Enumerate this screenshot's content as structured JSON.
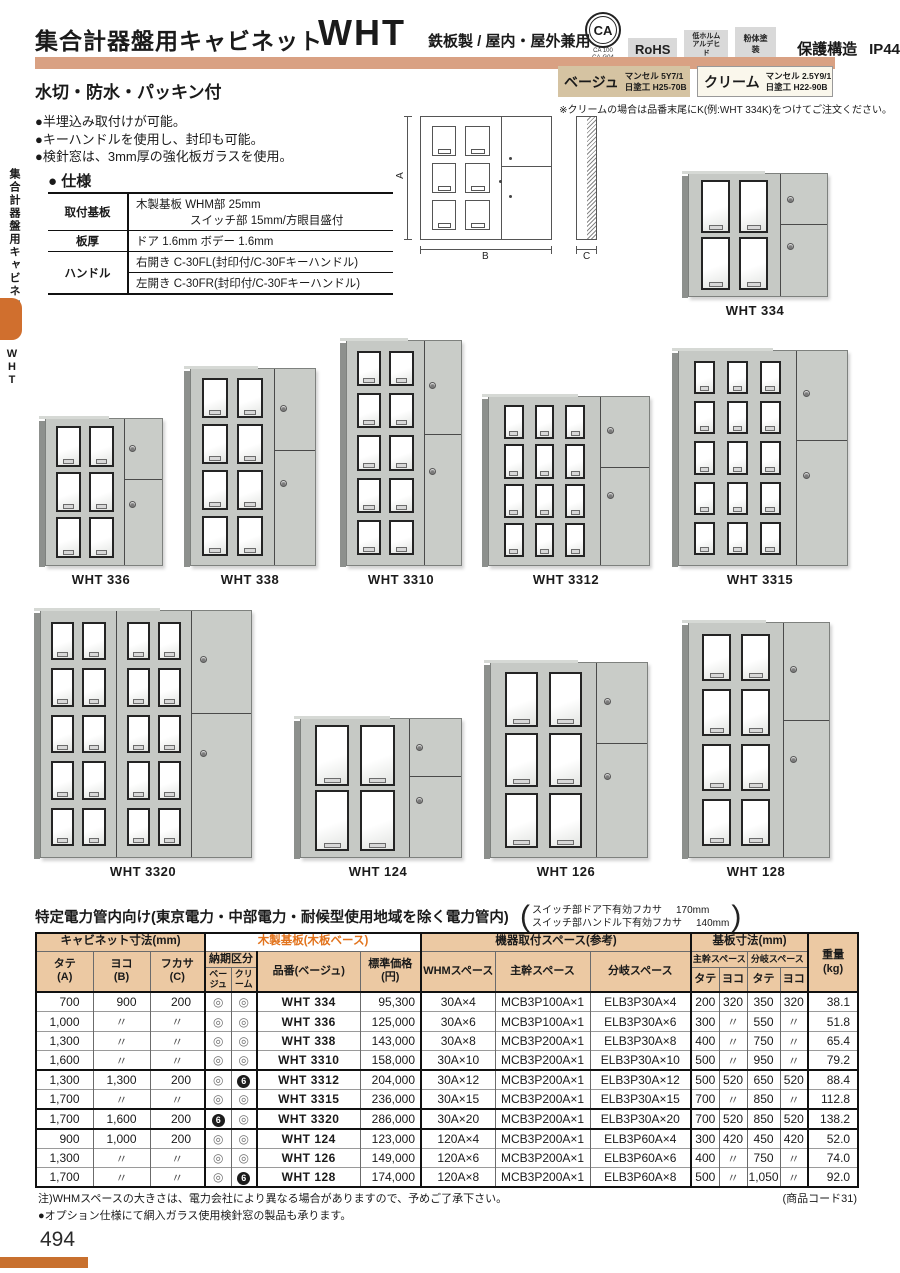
{
  "sidebar": {
    "title": "集合計器盤用キャビネット",
    "tab": "WHT"
  },
  "header": {
    "title": "集合計器盤用キャビネット",
    "model": "WHT",
    "subtitle": "鉄板製 / 屋内・屋外兼用",
    "ca": "CA",
    "ca_sub1": "CA 100",
    "ca_sub2": "CA-G04",
    "rohs": "RoHS",
    "formaldehyde1": "低ホルム",
    "formaldehyde2": "アルデヒド",
    "powder": "粉体塗装",
    "protection": "保護構造",
    "ip": "IP44"
  },
  "feature": "水切・防水・パッキン付",
  "colors": {
    "beige_name": "ベージュ",
    "beige_line1": "マンセル 5Y7/1",
    "beige_line2": "日塗工 H25-70B",
    "beige_hex": "#d5c3a2",
    "cream_name": "クリーム",
    "cream_line1": "マンセル 2.5Y9/1",
    "cream_line2": "日塗工 H22-90B",
    "cream_hex": "#faf7ec",
    "note": "※クリームの場合は品番末尾にK(例:WHT 334K)をつけてご注文ください。"
  },
  "bullets": [
    "●半埋込み取付けが可能。",
    "●キーハンドルを使用し、封印も可能。",
    "●検針窓は、3mm厚の強化板ガラスを使用。"
  ],
  "spec": {
    "heading": "● 仕様",
    "r1_label": "取付基板",
    "r1_line1": "木製基板 WHM部 25mm",
    "r1_line2": "スイッチ部 15mm/方眼目盛付",
    "r2_label": "板厚",
    "r2_value": "ドア 1.6mm ボデー 1.6mm",
    "r3_label": "ハンドル",
    "r3_value": "右開き C-30FL(封印付/C-30Fキーハンドル)",
    "r4_value": "左開き C-30FR(封印付/C-30Fキーハンドル)"
  },
  "diagram": {
    "a": "A",
    "b": "B",
    "c": "C"
  },
  "products": [
    {
      "label": "WHT 334",
      "doors": [
        {
          "cols": 2,
          "rows": 2
        }
      ]
    },
    {
      "label": "WHT 336",
      "doors": [
        {
          "cols": 2,
          "rows": 3
        }
      ]
    },
    {
      "label": "WHT 338",
      "doors": [
        {
          "cols": 2,
          "rows": 4
        }
      ]
    },
    {
      "label": "WHT 3310",
      "doors": [
        {
          "cols": 2,
          "rows": 5
        }
      ]
    },
    {
      "label": "WHT 3312",
      "doors": [
        {
          "cols": 3,
          "rows": 4
        }
      ]
    },
    {
      "label": "WHT 3315",
      "doors": [
        {
          "cols": 3,
          "rows": 5
        }
      ]
    },
    {
      "label": "WHT 3320",
      "doors": [
        {
          "cols": 2,
          "rows": 5
        },
        {
          "cols": 2,
          "rows": 5
        }
      ]
    },
    {
      "label": "WHT 124",
      "doors": [
        {
          "cols": 2,
          "rows": 2
        }
      ]
    },
    {
      "label": "WHT 126",
      "doors": [
        {
          "cols": 2,
          "rows": 3
        }
      ]
    },
    {
      "label": "WHT 128",
      "doors": [
        {
          "cols": 2,
          "rows": 4
        }
      ]
    }
  ],
  "table": {
    "title": "特定電力管内向け(東京電力・中部電力・耐候型使用地域を除く電力管内)",
    "note1_label": "スイッチ部ドア下有効フカサ",
    "note1_value": "170mm",
    "note2_label": "スイッチ部ハンドル下有効フカサ",
    "note2_value": "140mm",
    "h_cabinet": "キャビネット寸法(mm)",
    "h_wood": "木製基板(木板ベース)",
    "h_equip": "機器取付スペース(参考)",
    "h_board": "基板寸法(mm)",
    "h_weight1": "重量",
    "h_weight2": "(kg)",
    "h_tate1": "タテ",
    "h_tate2": "(A)",
    "h_yoko1": "ヨコ",
    "h_yoko2": "(B)",
    "h_fukasa1": "フカサ",
    "h_fukasa2": "(C)",
    "h_delivery": "納期区分",
    "h_beige": "ベージュ",
    "h_cream": "クリーム",
    "h_model": "品番(ベージュ)",
    "h_price1": "標準価格",
    "h_price2": "(円)",
    "h_whm": "WHMスペース",
    "h_main": "主幹スペース",
    "h_branch": "分岐スペース",
    "h_main_sub": "主幹スペース",
    "h_branch_sub": "分岐スペース",
    "h_sub_tate": "タテ",
    "h_sub_yoko": "ヨコ",
    "rows": [
      [
        "700",
        "900",
        "200",
        "◎",
        "◎",
        "WHT 334",
        "95,300",
        "30A×4",
        "MCB3P100A×1",
        "ELB3P30A×4",
        "200",
        "320",
        "350",
        "320",
        "38.1"
      ],
      [
        "1,000",
        "〃",
        "〃",
        "◎",
        "◎",
        "WHT 336",
        "125,000",
        "30A×6",
        "MCB3P100A×1",
        "ELB3P30A×6",
        "300",
        "〃",
        "550",
        "〃",
        "51.8"
      ],
      [
        "1,300",
        "〃",
        "〃",
        "◎",
        "◎",
        "WHT 338",
        "143,000",
        "30A×8",
        "MCB3P200A×1",
        "ELB3P30A×8",
        "400",
        "〃",
        "750",
        "〃",
        "65.4"
      ],
      [
        "1,600",
        "〃",
        "〃",
        "◎",
        "◎",
        "WHT 3310",
        "158,000",
        "30A×10",
        "MCB3P200A×1",
        "ELB3P30A×10",
        "500",
        "〃",
        "950",
        "〃",
        "79.2"
      ],
      [
        "1,300",
        "1,300",
        "200",
        "◎",
        "6",
        "WHT 3312",
        "204,000",
        "30A×12",
        "MCB3P200A×1",
        "ELB3P30A×12",
        "500",
        "520",
        "650",
        "520",
        "88.4"
      ],
      [
        "1,700",
        "〃",
        "〃",
        "◎",
        "◎",
        "WHT 3315",
        "236,000",
        "30A×15",
        "MCB3P200A×1",
        "ELB3P30A×15",
        "700",
        "〃",
        "850",
        "〃",
        "112.8"
      ],
      [
        "1,700",
        "1,600",
        "200",
        "6",
        "◎",
        "WHT 3320",
        "286,000",
        "30A×20",
        "MCB3P200A×1",
        "ELB3P30A×20",
        "700",
        "520",
        "850",
        "520",
        "138.2"
      ],
      [
        "900",
        "1,000",
        "200",
        "◎",
        "◎",
        "WHT 124",
        "123,000",
        "120A×4",
        "MCB3P200A×1",
        "ELB3P60A×4",
        "300",
        "420",
        "450",
        "420",
        "52.0"
      ],
      [
        "1,300",
        "〃",
        "〃",
        "◎",
        "◎",
        "WHT 126",
        "149,000",
        "120A×6",
        "MCB3P200A×1",
        "ELB3P60A×6",
        "400",
        "〃",
        "750",
        "〃",
        "74.0"
      ],
      [
        "1,700",
        "〃",
        "〃",
        "◎",
        "6",
        "WHT 128",
        "174,000",
        "120A×8",
        "MCB3P200A×1",
        "ELB3P60A×8",
        "500",
        "〃",
        "1,050",
        "〃",
        "92.0"
      ]
    ],
    "thick_after": [
      3,
      5,
      6
    ]
  },
  "footnotes": {
    "note": "注)WHMスペースの大きさは、電力会社により異なる場合がありますので、予めご了承下さい。",
    "code": "(商品コード31)",
    "option": "●オプション仕様にて網入ガラス使用検針窓の製品も承ります。"
  },
  "page_number": "494"
}
